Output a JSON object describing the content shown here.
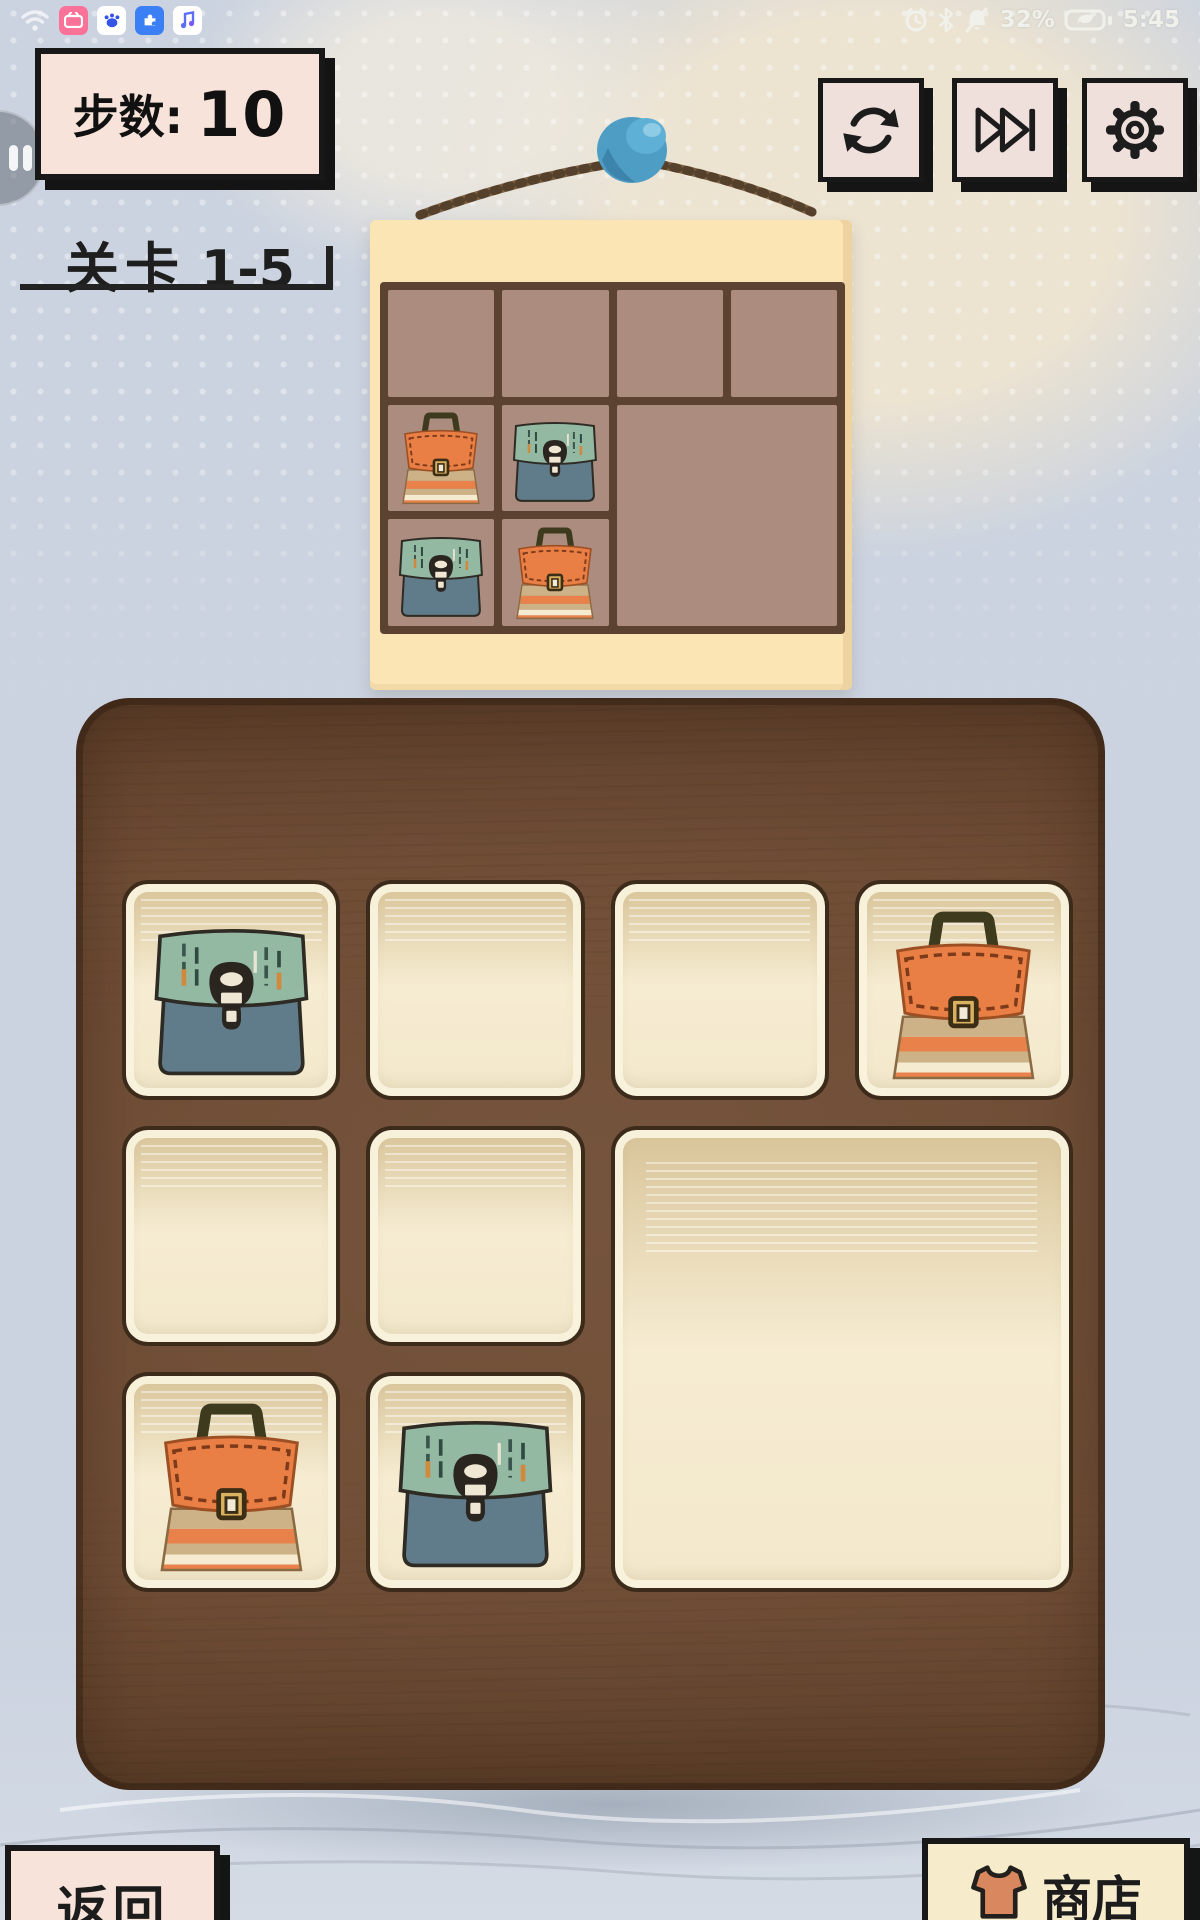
{
  "status_bar": {
    "battery_percent": "32%",
    "time": "5:45",
    "left_icons": [
      "wifi-icon",
      "video-app-icon",
      "paw-app-icon",
      "puzzle-app-icon",
      "music-app-icon"
    ],
    "right_icons": [
      "alarm-icon",
      "bluetooth-icon",
      "mute-bell-icon",
      "battery-saver-icon"
    ]
  },
  "hud": {
    "steps_label": "步数:",
    "steps_value": "10",
    "level_label": "关卡",
    "level_value": "1-5"
  },
  "toolbar": {
    "buttons": [
      "restart-icon",
      "skip-level-icon",
      "settings-gear-icon"
    ]
  },
  "footer": {
    "back_label": "返回",
    "shop_label": "商店",
    "shop_icon": "shirt-icon"
  },
  "reference_board": {
    "rows": 3,
    "cols": 4,
    "cells": [
      {
        "r": 1,
        "c": 1,
        "bag": null
      },
      {
        "r": 1,
        "c": 2,
        "bag": null
      },
      {
        "r": 1,
        "c": 3,
        "bag": null
      },
      {
        "r": 1,
        "c": 4,
        "bag": null
      },
      {
        "r": 2,
        "c": 1,
        "bag": "orange"
      },
      {
        "r": 2,
        "c": 2,
        "bag": "green"
      },
      {
        "r": 2,
        "c": 3,
        "rowspan": 2,
        "colspan": 2,
        "bag": null
      },
      {
        "r": 3,
        "c": 1,
        "bag": "green"
      },
      {
        "r": 3,
        "c": 2,
        "bag": "orange"
      }
    ]
  },
  "main_board": {
    "rows": 3,
    "cols": 4,
    "cells": [
      {
        "r": 1,
        "c": 1,
        "bag": "green"
      },
      {
        "r": 1,
        "c": 2,
        "bag": null
      },
      {
        "r": 1,
        "c": 3,
        "bag": null
      },
      {
        "r": 1,
        "c": 4,
        "bag": "orange"
      },
      {
        "r": 2,
        "c": 1,
        "bag": null
      },
      {
        "r": 2,
        "c": 2,
        "bag": null
      },
      {
        "r": 2,
        "c": 3,
        "rowspan": 2,
        "colspan": 2,
        "bag": null
      },
      {
        "r": 3,
        "c": 1,
        "bag": "orange"
      },
      {
        "r": 3,
        "c": 2,
        "bag": "green"
      }
    ]
  },
  "palette": {
    "page_bg": "#cbd3e0",
    "board_brown": "#6d4a32",
    "cell_cream": "#f5ecd2",
    "ref_board_cream": "#fbe5b4",
    "ref_cell_mauve": "#ab8c7e",
    "grid_line_brown": "#5b4231",
    "panel_pink": "#f7e3d9",
    "panel_cream": "#f6eccb",
    "ink": "#1b1b1b",
    "pin_blue": "#4e9dc5",
    "bag_green_flap": "#94b9a3",
    "bag_green_body": "#607b89",
    "bag_orange_flap": "#e97f45",
    "bag_orange_stripe_tan": "#cdb288",
    "bag_orange_stripe_cream": "#f5ebd1"
  }
}
